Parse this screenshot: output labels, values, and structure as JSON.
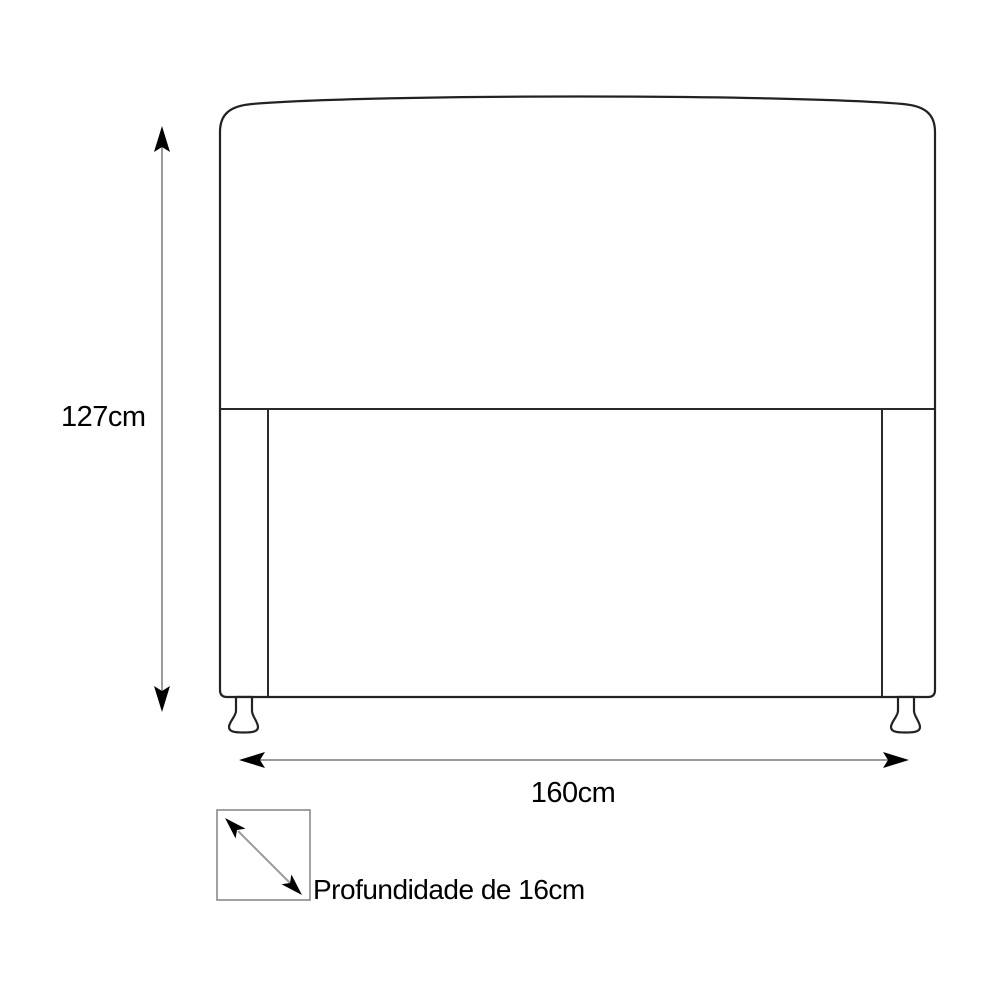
{
  "diagram": {
    "subject": "headboard-front-view-dimension-drawing",
    "labels": {
      "height": "127cm",
      "width": "160cm",
      "depth": "Profundidade de 16cm"
    },
    "dimensions": {
      "height_cm": 127,
      "width_cm": 160,
      "depth_cm": 16
    },
    "icons": {
      "height_arrow": "vertical-double-arrow-icon",
      "width_arrow": "horizontal-double-arrow-icon",
      "depth_arrow": "diagonal-double-arrow-icon"
    },
    "colors": {
      "background": "#ffffff",
      "outline": "#222222",
      "dimension_shaft": "#9b9b9b",
      "arrowhead": "#000000",
      "depth_box_border": "#8a8a8a",
      "text": "#000000"
    }
  }
}
